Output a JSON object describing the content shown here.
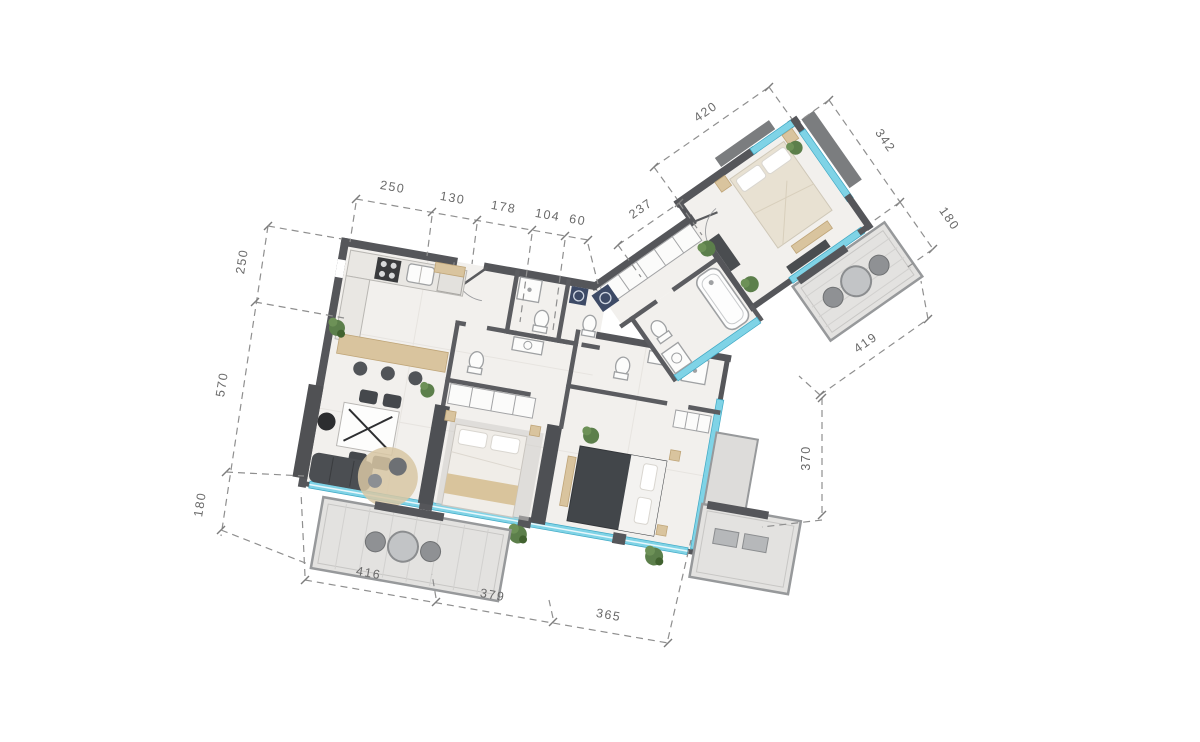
{
  "title": "apartment-floor-plan",
  "dimensions": {
    "top_chain": [
      "250",
      "130",
      "178",
      "104",
      "60"
    ],
    "wing_chain": [
      "237",
      "420"
    ],
    "wing_side": [
      "342",
      "180"
    ],
    "right_side": [
      "419",
      "370"
    ],
    "left_chain": [
      "250",
      "570",
      "180"
    ],
    "bottom_chain": [
      "416",
      "379",
      "365"
    ]
  },
  "colors": {
    "background": "#ffffff",
    "wall": "#55565a",
    "floor": "#f2f0ed",
    "window_glass": "#7fd3e6",
    "window_frame": "#3fa8c4",
    "wood": "#d9c49e",
    "balcony_floor": "#e3e2e0",
    "dark_furniture": "#45484c",
    "plant": "#5c7f4b",
    "rug": "#d8c7a3",
    "dimension_line": "#8f8f8f",
    "dimension_text": "#6a6a6a"
  },
  "icons": {
    "furniture": [
      "kitchen-counter",
      "stove",
      "sink",
      "fridge",
      "breakfast-bar",
      "bar-stool",
      "dining-table",
      "dining-chair",
      "armchair",
      "sofa",
      "round-rug",
      "pouf",
      "double-bed",
      "pillow",
      "nightstand",
      "wardrobe",
      "tv-wall",
      "dresser",
      "bench",
      "toilet",
      "shower",
      "bathtub",
      "washing-machine",
      "vanity-sink",
      "balcony-table",
      "balcony-chair",
      "plant",
      "ac-ledge"
    ]
  }
}
